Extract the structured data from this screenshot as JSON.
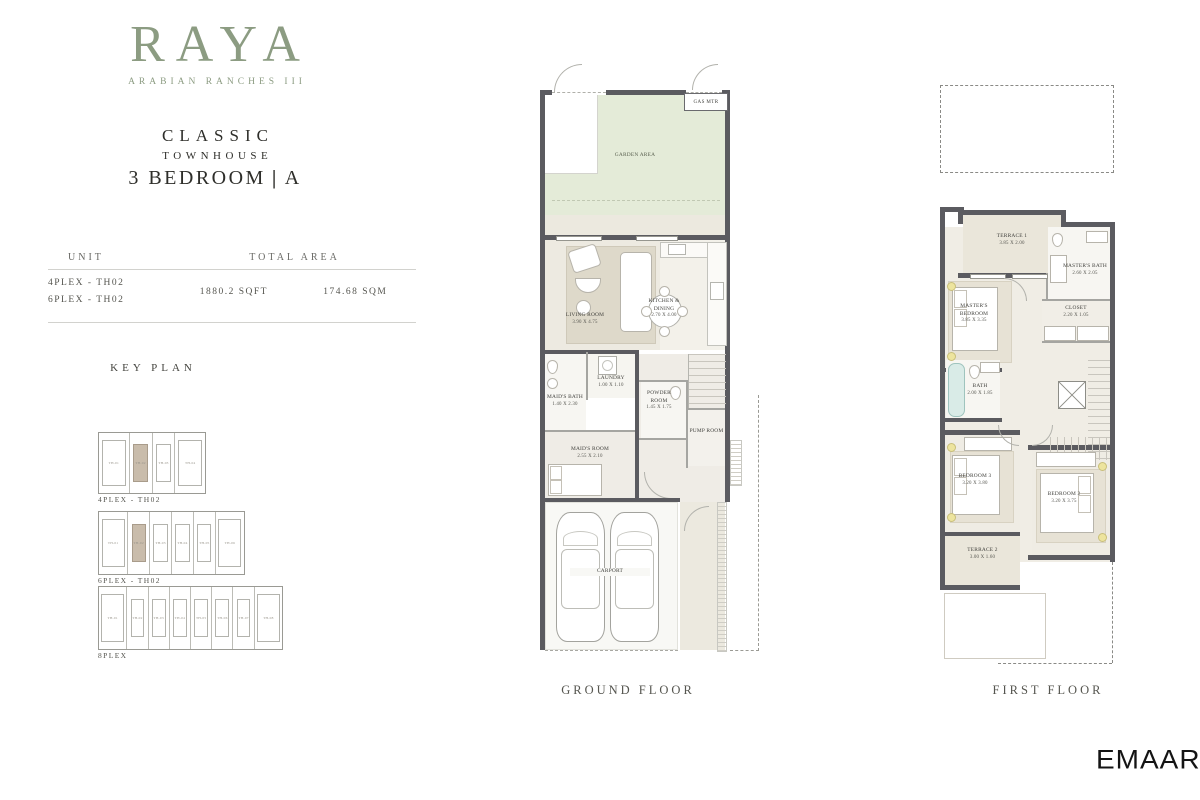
{
  "brand": {
    "logo_text": "RAYA",
    "logo_sub": "ARABIAN  RANCHES  III",
    "logo_color": "#8C9C82",
    "emaar": "EMAAR"
  },
  "title": {
    "line1": "CLASSIC",
    "line2": "TOWNHOUSE",
    "line3": "3 BEDROOM",
    "divider": "|",
    "variant": "A"
  },
  "area_table": {
    "col_unit": "UNIT",
    "col_total": "TOTAL AREA",
    "units": [
      "4PLEX - TH02",
      "6PLEX - TH02"
    ],
    "sqft": "1880.2 SQFT",
    "sqm": "174.68 SQM"
  },
  "key_plan": {
    "title": "KEY PLAN",
    "plans": [
      {
        "label": "4PLEX - TH02",
        "units": [
          "TH-01",
          "TH-02",
          "TH-03",
          "TH-04"
        ]
      },
      {
        "label": "6PLEX - TH02",
        "units": [
          "TH-01",
          "TH-02",
          "TH-03",
          "TH-04",
          "TH-05",
          "TH-06"
        ]
      },
      {
        "label": "8PLEX",
        "units": [
          "TH-01",
          "TH-02",
          "TH-03",
          "TH-04",
          "TH-05",
          "TH-06",
          "TH-07",
          "TH-08"
        ]
      }
    ],
    "highlight_color": "#C9BCAB"
  },
  "ground_floor": {
    "label": "GROUND FLOOR",
    "garden": {
      "name": "GARDEN AREA"
    },
    "gas": {
      "name": "GAS MTR"
    },
    "living": {
      "name": "LIVING ROOM",
      "dims": "3.90 X 4.75"
    },
    "kitchen": {
      "name": "KITCHEN & DINING",
      "dims": "2.70 X 4.00"
    },
    "laundry": {
      "name": "LAUNDRY",
      "dims": "1.00 X 1.10"
    },
    "maids_bath": {
      "name": "MAID'S BATH",
      "dims": "1.40 X 2.30"
    },
    "maids_room": {
      "name": "MAID'S ROOM",
      "dims": "2.55 X 2.10"
    },
    "powder": {
      "name": "POWDER ROOM",
      "dims": "1.45 X 1.75"
    },
    "pump": {
      "name": "PUMP ROOM"
    },
    "carport": {
      "name": "CARPORT"
    }
  },
  "first_floor": {
    "label": "FIRST FLOOR",
    "terrace1": {
      "name": "TERRACE 1",
      "dims": "3.85 X 2.00"
    },
    "master_bed": {
      "name": "MASTER'S BEDROOM",
      "dims": "3.85 X 3.35"
    },
    "master_bath": {
      "name": "MASTER'S BATH",
      "dims": "2.60 X 2.05"
    },
    "closet": {
      "name": "CLOSET",
      "dims": "2.20 X 1.05"
    },
    "bath": {
      "name": "BATH",
      "dims": "2.00 X 1.85"
    },
    "bed3": {
      "name": "BEDROOM 3",
      "dims": "3.20 X 3.80"
    },
    "bed2": {
      "name": "BEDROOM 2",
      "dims": "3.20 X 3.75"
    },
    "terrace2": {
      "name": "TERRACE 2",
      "dims": "3.00 X 1.60"
    }
  },
  "colors": {
    "accent_green": "#8C9C82",
    "wall": "#5B5B60",
    "garden": "#E4EBD8",
    "floor": "#EFECE4",
    "terrace": "#EAE6DA",
    "keyplan_highlight": "#C9BCAB"
  }
}
